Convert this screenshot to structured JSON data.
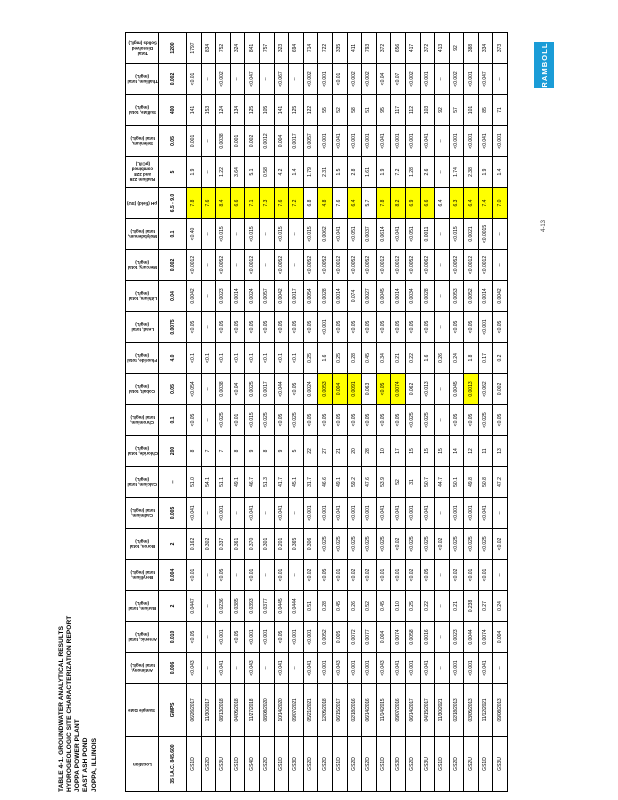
{
  "page": {
    "title_lines": [
      "TABLE 4-1. GROUNDWATER ANALYTICAL RESULTS",
      "HYDROGEOLOGIC SITE CHARACTERIZATION REPORT",
      "JOPPA POWER PLANT",
      "EAST ASH POND",
      "JOPPA, ILLINOIS"
    ],
    "page_number": "4-13",
    "logo_text": "RAMBOLL",
    "logo_color": "#1a9cd7",
    "highlight_color": "#ffff00"
  },
  "table": {
    "row_header_labels": {
      "location": "Location",
      "sample_date": "Sample Date"
    },
    "standards_row": {
      "location": "35 I.A.C. 845.600",
      "sample_date": "GWPS"
    },
    "analytes": [
      {
        "name": "Antimony, total (mg/L)",
        "std": "0.006",
        "values": [
          "<0.043",
          "--",
          "<0.041",
          "--",
          "<0.043",
          "--",
          "<0.041",
          "--",
          "<0.041",
          "<0.001",
          "<0.043",
          "<0.001",
          "<0.001",
          "<0.043",
          "<0.041",
          "<0.001",
          "<0.041",
          "--",
          "<0.001",
          "<0.001",
          "<0.041",
          "--"
        ]
      },
      {
        "name": "Arsenic, total (mg/L)",
        "std": "0.010",
        "values": [
          "<0.05",
          "--",
          "<0.001",
          "<0.05",
          "<0.001",
          "<0.001",
          "<0.05",
          "<0.001",
          "<0.001",
          "0.0052",
          "0.005",
          "0.0072",
          "0.0077",
          "0.004",
          "0.0074",
          "0.0058",
          "0.0016",
          "--",
          "0.0023",
          "0.0044",
          "0.0074",
          "0.004"
        ]
      },
      {
        "name": "Barium, total (mg/L)",
        "std": "2",
        "values": [
          "0.0447",
          "--",
          "0.0236",
          "0.0385",
          "0.0393",
          "0.0377",
          "0.0445",
          "0.0444",
          "0.51",
          "0.28",
          "0.45",
          "0.26",
          "0.52",
          "0.45",
          "0.10",
          "0.25",
          "0.22",
          "--",
          "0.21",
          "0.238",
          "0.27",
          "0.24"
        ]
      },
      {
        "name": "Beryllium, total (mg/L)",
        "std": "0.004",
        "values": [
          "<0.01",
          "--",
          "<0.05",
          "--",
          "<0.01",
          "--",
          "<0.01",
          "--",
          "<0.02",
          "<0.05",
          "<0.01",
          "<0.02",
          "<0.02",
          "<0.01",
          "<0.01",
          "<0.02",
          "<0.05",
          "--",
          "<0.02",
          "<0.01",
          "<0.01",
          "--"
        ]
      },
      {
        "name": "Boron, total (mg/L)",
        "std": "2",
        "values": [
          "0.162",
          "0.302",
          "0.337",
          "0.361",
          "0.370",
          "0.301",
          "0.201",
          "0.365",
          "0.306",
          "<0.025",
          "<0.025",
          "<0.025",
          "<0.025",
          "<0.025",
          "<0.02",
          "<0.025",
          "<0.025",
          "<0.02",
          "<0.025",
          "<0.025",
          "<0.025",
          "<0.02"
        ]
      },
      {
        "name": "Cadmium, total (mg/L)",
        "std": "0.005",
        "values": [
          "<0.041",
          "--",
          "<0.001",
          "--",
          "<0.041",
          "--",
          "<0.041",
          "--",
          "<0.001",
          "<0.001",
          "<0.041",
          "<0.001",
          "<0.001",
          "<0.041",
          "<0.041",
          "<0.001",
          "<0.041",
          "--",
          "<0.001",
          "<0.001",
          "<0.041",
          "--"
        ]
      },
      {
        "name": "Calcium, total (mg/L)",
        "std": "--",
        "values": [
          "51.0",
          "54.1",
          "51.1",
          "49.1",
          "46.7",
          "51.3",
          "41.7",
          "45.1",
          "31.7",
          "46.6",
          "49.1",
          "59.2",
          "47.6",
          "53.9",
          "52",
          "31",
          "50.7",
          "44.7",
          "50.1",
          "49.8",
          "50.8",
          "47.2"
        ]
      },
      {
        "name": "Chloride, total (mg/L)",
        "std": "200",
        "values": [
          "8",
          "7",
          "7",
          "8",
          "9",
          "8",
          "9",
          "5",
          "22",
          "27",
          "21",
          "20",
          "28",
          "10",
          "17",
          "15",
          "15",
          "15",
          "14",
          "12",
          "11",
          "13"
        ]
      },
      {
        "name": "Chromium, total (mg/L)",
        "std": "0.1",
        "values": [
          "<0.05",
          "--",
          "<0.025",
          "<0.01",
          "<0.015",
          "<0.025",
          "<0.05",
          "<0.025",
          "<0.05",
          "<0.05",
          "<0.05",
          "<0.05",
          "<0.05",
          "<0.05",
          "<0.05",
          "<0.025",
          "<0.025",
          "--",
          "<0.05",
          "<0.05",
          "<0.025",
          "<0.05"
        ]
      },
      {
        "name": "Cobalt, total (mg/L)",
        "std": "0.05",
        "values": [
          "<0.054",
          "--",
          "0.0038",
          "<0.04",
          "0.0025",
          "0.0017",
          "<0.044",
          "<0.05",
          "0.0024",
          "0.0053",
          "0.004",
          "0.0091",
          "0.063",
          "<0.05",
          "0.0074",
          "0.062",
          "<0.013",
          "--",
          "0.0045",
          "0.0013",
          "<0.062",
          "0.002"
        ],
        "highlight_idx": [
          9,
          10,
          11,
          13,
          14,
          19
        ]
      },
      {
        "name": "Fluoride, total (mg/L)",
        "std": "4.0",
        "values": [
          "<0.1",
          "<0.1",
          "<0.1",
          "<0.1",
          "<0.1",
          "<0.1",
          "<0.1",
          "<0.1",
          "0.25",
          "1.6",
          "0.25",
          "0.28",
          "0.45",
          "0.34",
          "0.21",
          "0.22",
          "1.6",
          "0.26",
          "0.24",
          "1.8",
          "0.17",
          "0.2"
        ]
      },
      {
        "name": "Lead, total (mg/L)",
        "std": "0.0075",
        "values": [
          "<0.05",
          "--",
          "<0.05",
          "<0.05",
          "<0.05",
          "<0.05",
          "<0.05",
          "<0.05",
          "<0.05",
          "<0.001",
          "<0.05",
          "<0.05",
          "<0.05",
          "<0.05",
          "<0.05",
          "<0.05",
          "<0.05",
          "--",
          "<0.05",
          "<0.05",
          "<0.001",
          "<0.05"
        ]
      },
      {
        "name": "Lithium, total (mg/L)",
        "std": "0.04",
        "values": [
          "0.0042",
          "--",
          "0.0023",
          "0.0014",
          "0.0024",
          "0.0057",
          "0.0042",
          "0.0017",
          "0.0054",
          "0.0028",
          "0.0014",
          "0.074",
          "0.0027",
          "0.0045",
          "0.0014",
          "0.0034",
          "0.0028",
          "--",
          "0.0053",
          "0.0052",
          "0.0014",
          "0.0042"
        ]
      },
      {
        "name": "Mercury, total (mg/L)",
        "std": "0.002",
        "values": [
          "<0.0012",
          "--",
          "<0.0052",
          "--",
          "<0.0012",
          "--",
          "<0.0052",
          "--",
          "<0.0052",
          "<0.0052",
          "<0.0012",
          "<0.0052",
          "<0.0052",
          "<0.0012",
          "<0.0012",
          "<0.0052",
          "<0.0062",
          "--",
          "<0.0052",
          "<0.0012",
          "<0.0012",
          "--"
        ]
      },
      {
        "name": "Molybdenum, total (mg/L)",
        "std": "0.1",
        "values": [
          "<0.40",
          "--",
          "<0.015",
          "--",
          "<0.015",
          "--",
          "<0.015",
          "--",
          "<0.015",
          "0.0062",
          "<0.041",
          "<0.051",
          "0.0037",
          "0.0614",
          "<0.041",
          "<0.051",
          "0.0011",
          "--",
          "<0.015",
          "0.0021",
          "<0.0015",
          "--"
        ]
      },
      {
        "name": "pH (field) (SU)",
        "std": "6.5 - 9.0",
        "values": [
          "7.8",
          "7.6",
          "8.4",
          "6.6",
          "7.1",
          "7.3",
          "7.6",
          "7.2",
          "6.8",
          "4.8",
          "7.6",
          "6.4",
          "5.7",
          "7.8",
          "8.2",
          "6.9",
          "6.6",
          "6.4",
          "6.3",
          "6.4",
          "7.4",
          "7.0"
        ],
        "highlight_all_except_idx": [
          8,
          10,
          12,
          17
        ]
      },
      {
        "name": "Radium 226 and 228 combined (pCi/L)",
        "std": "5",
        "values": [
          "1.9",
          "--",
          "1.22",
          "3.64",
          "5.1",
          "0.58",
          "4.2",
          "1.4",
          "1.79",
          "2.31",
          "1.5",
          "2.8",
          "1.61",
          "1.9",
          "7.2",
          "1.28",
          "2.6",
          "--",
          "1.74",
          "2.38",
          "1.9",
          "1.4"
        ]
      },
      {
        "name": "Selenium, total (mg/L)",
        "std": "0.05",
        "values": [
          "0.001",
          "--",
          "0.0038",
          "0.001",
          "0.002",
          "0.0012",
          "0.004",
          "0.0017",
          "0.0057",
          "<0.001",
          "<0.041",
          "<0.001",
          "<0.001",
          "<0.041",
          "<0.001",
          "<0.001",
          "<0.041",
          "--",
          "<0.001",
          "<0.001",
          "<0.041",
          "<0.001"
        ]
      },
      {
        "name": "Sulfate, total (mg/L)",
        "std": "400",
        "values": [
          "141",
          "153",
          "124",
          "134",
          "125",
          "105",
          "141",
          "125",
          "122",
          "55",
          "52",
          "58",
          "51",
          "95",
          "117",
          "112",
          "103",
          "92",
          "57",
          "101",
          "85",
          "71"
        ]
      },
      {
        "name": "Thallium, total (mg/L)",
        "std": "0.002",
        "values": [
          "<0.01",
          "--",
          "<0.002",
          "--",
          "<0.047",
          "--",
          "<0.067",
          "--",
          "<0.002",
          "<0.001",
          "<0.01",
          "<0.002",
          "<0.002",
          "<0.04",
          "<0.07",
          "<0.002",
          "<0.001",
          "--",
          "<0.002",
          "<0.001",
          "<0.047",
          "--"
        ]
      },
      {
        "name": "Total Dissolved Solids (mg/L)",
        "std": "1200",
        "values": [
          "1797",
          "834",
          "752",
          "324",
          "841",
          "757",
          "323",
          "694",
          "714",
          "722",
          "335",
          "411",
          "793",
          "372",
          "656",
          "417",
          "372",
          "413",
          "92",
          "388",
          "334",
          "373"
        ]
      }
    ],
    "samples": [
      {
        "location": "GS1D",
        "date": "06/26/2017"
      },
      {
        "location": "GS2D",
        "date": "11/30/2017"
      },
      {
        "location": "GS3U",
        "date": "08/13/2018"
      },
      {
        "location": "GS1D",
        "date": "04/05/2018"
      },
      {
        "location": "GS4D",
        "date": "11/27/2018"
      },
      {
        "location": "GS2D",
        "date": "08/08/2020"
      },
      {
        "location": "GS1D",
        "date": "10/14/2020"
      },
      {
        "location": "GS3D",
        "date": "09/07/2021"
      },
      {
        "location": "GS2D",
        "date": "05/21/2021"
      },
      {
        "location": "GS2D",
        "date": "12/05/2018"
      },
      {
        "location": "GS1D",
        "date": "06/15/2017"
      },
      {
        "location": "GS2D",
        "date": "02/18/2016"
      },
      {
        "location": "GS2D",
        "date": "06/14/2016"
      },
      {
        "location": "GS1D",
        "date": "11/14/2015"
      },
      {
        "location": "GS3D",
        "date": "09/07/2016"
      },
      {
        "location": "GS2D",
        "date": "06/14/2017"
      },
      {
        "location": "GS3U",
        "date": "04/15/2017"
      },
      {
        "location": "GS1D",
        "date": "11/30/2021"
      },
      {
        "location": "GS2D",
        "date": "02/18/2013"
      },
      {
        "location": "GS2U",
        "date": "03/05/2013"
      },
      {
        "location": "GS1D",
        "date": "11/12/2021"
      },
      {
        "location": "GS3U",
        "date": "09/08/2013"
      }
    ]
  }
}
